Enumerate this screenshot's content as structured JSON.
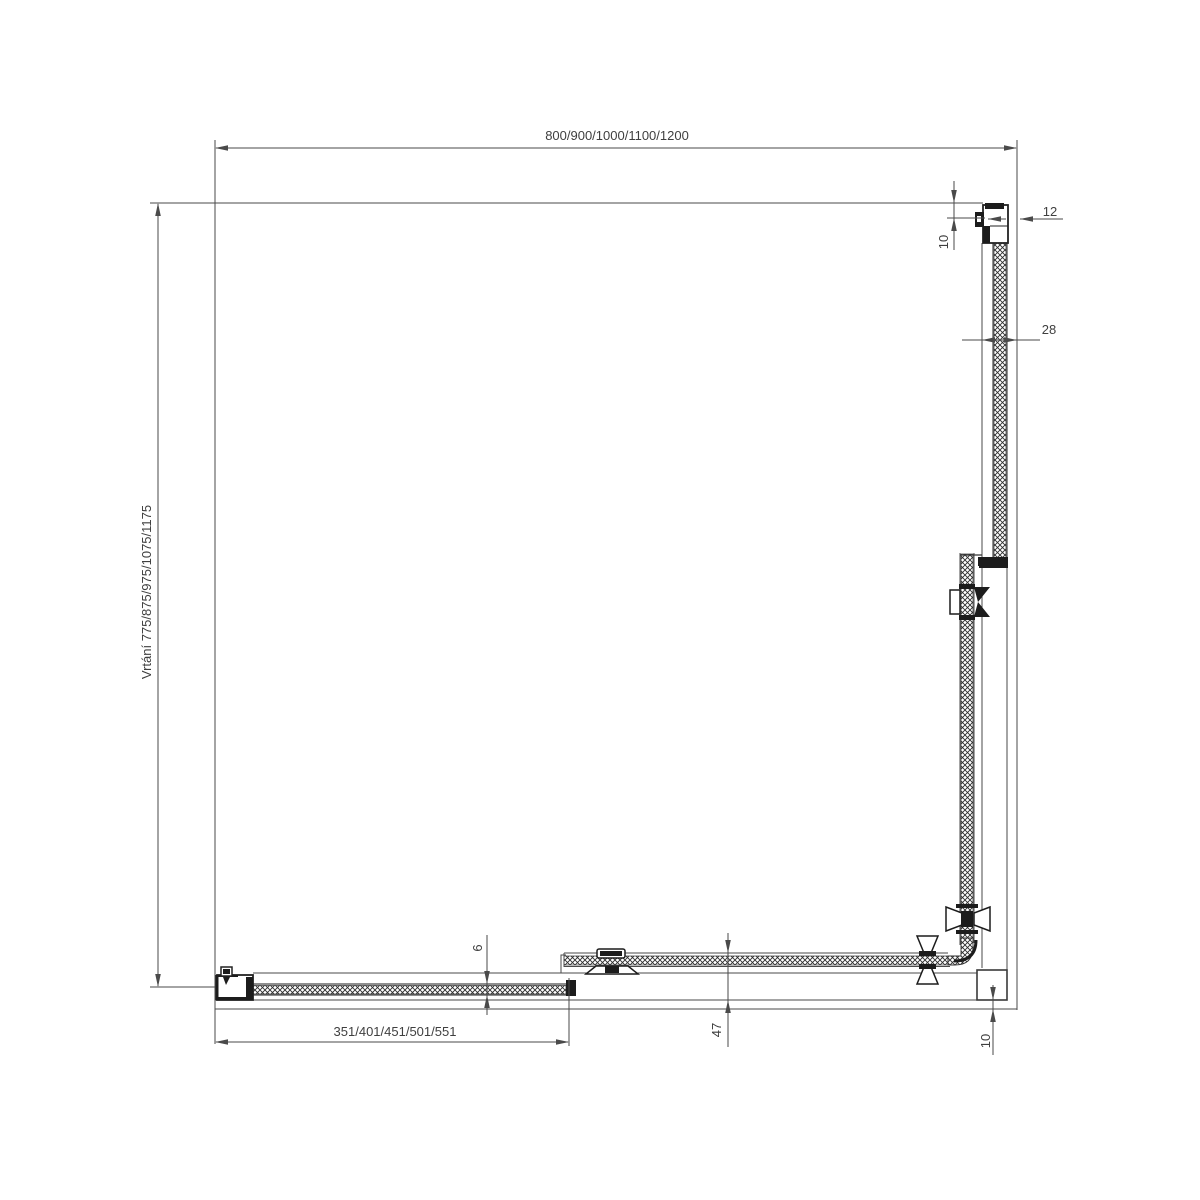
{
  "drawing": {
    "colors": {
      "line": "#4a4a4a",
      "detail": "#1c1c1c",
      "text": "#3f3f3f",
      "background": "#ffffff"
    },
    "dimensions": {
      "top_width": "800/900/1000/1100/1200",
      "left_drilling": "Vrtání 775/875/975/1075/1175",
      "bottom_fixed_panel": "351/401/451/501/551",
      "top_right_offset": "10",
      "wall_profile_depth": "12",
      "panel_profile_width": "28",
      "glass_thickness": "6",
      "door_edge_distance": "47",
      "bottom_right_offset": "10"
    }
  }
}
